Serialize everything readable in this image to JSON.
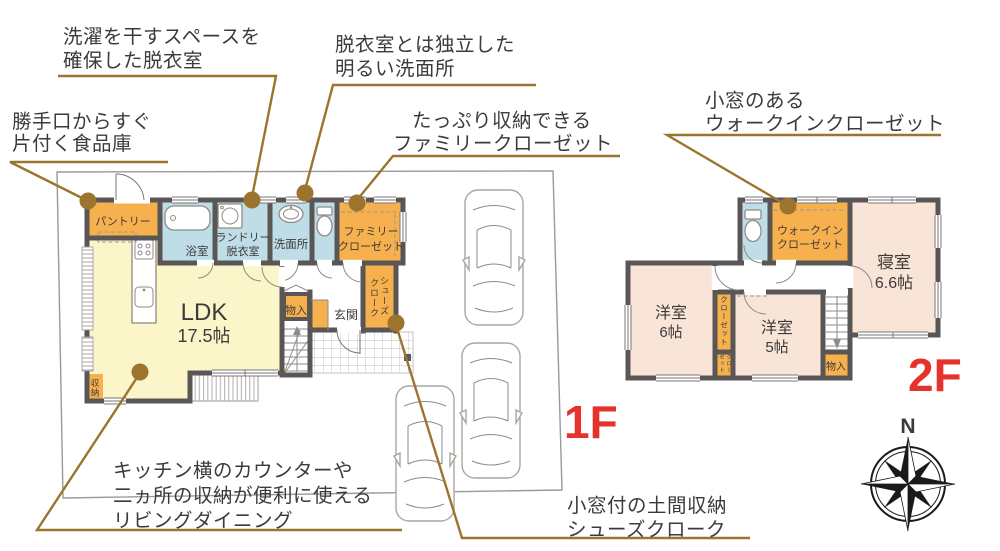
{
  "f1": {
    "floor_label": "1F",
    "pantry": "パントリー",
    "bath": "浴室",
    "laundry": [
      "ランドリー",
      "脱衣室"
    ],
    "washroom": "洗面所",
    "family_closet": [
      "ファミリー",
      "クローゼット"
    ],
    "ldk": [
      "LDK",
      "17.5帖"
    ],
    "storage": "収納",
    "monoire": "物入",
    "entrance": "玄関",
    "shoes_cloak": [
      "シューズ",
      "クローク"
    ]
  },
  "f2": {
    "floor_label": "2F",
    "wic": [
      "ウォークイン",
      "クローゼット"
    ],
    "bedroom": [
      "寝室",
      "6.6帖"
    ],
    "western6": [
      "洋室",
      "6帖"
    ],
    "western5": [
      "洋室",
      "5帖"
    ],
    "closet": "クローゼット",
    "closet_small": [
      "クロー",
      "ゼット"
    ],
    "monoire": "物入"
  },
  "annotations": {
    "laundry_space": {
      "lines": [
        "洗濯を干すスペースを",
        "確保した脱衣室"
      ]
    },
    "washroom_independent": {
      "lines": [
        "脱衣室とは独立した",
        "明るい洗面所"
      ]
    },
    "family_closet": {
      "lines": [
        "たっぷり収納できる",
        "ファミリークローゼット"
      ]
    },
    "pantry": {
      "lines": [
        "勝手口からすぐ",
        "片付く食品庫"
      ]
    },
    "wic": {
      "lines": [
        "小窓のある",
        "ウォークインクローゼット"
      ]
    },
    "living": {
      "lines": [
        "キッチン横のカウンターや",
        "二ヵ所の収納が便利に使える",
        "リビングダイニング"
      ]
    },
    "shoes_cloak": {
      "lines": [
        "小窓付の土間収納",
        "シューズクローク"
      ]
    }
  },
  "compass": {
    "north": "N"
  },
  "colors": {
    "wall": "#5a5656",
    "room_orange": "#f6b14e",
    "room_yellow": "#faf6c9",
    "room_blue": "#bedde6",
    "room_pink": "#f9e4d8",
    "leader_brown": "#9c742e",
    "floor_label_red": "#e5332c",
    "text": "#3e3a39"
  }
}
